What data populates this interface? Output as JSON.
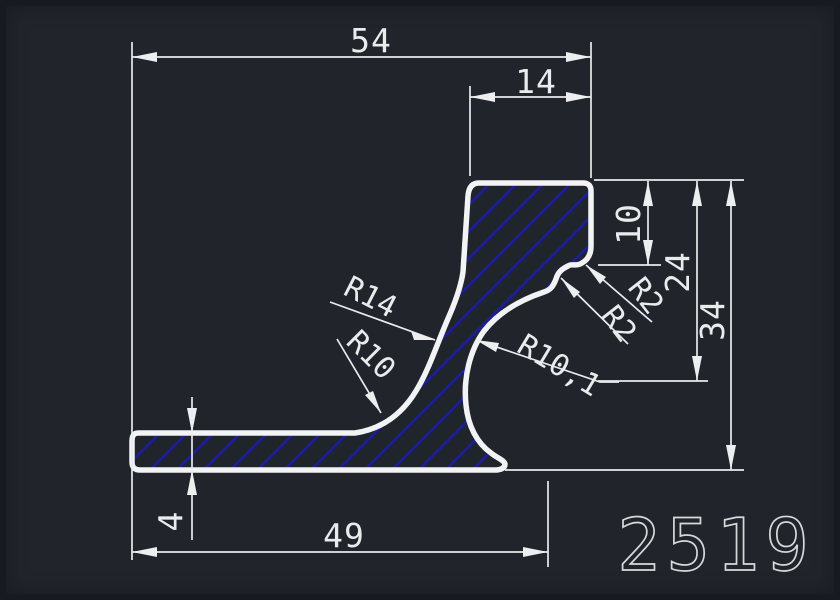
{
  "canvas": {
    "background": "#21252b",
    "frame_color": "#171b21",
    "line_color": "#e8eaec",
    "outline_color": "#f2f3f5",
    "hatch_color": "#1b1bb2",
    "text_color": "#e9ebed",
    "part_number_color": "#d6d8da"
  },
  "drawing": {
    "part_number": "2519",
    "dimensions": {
      "overall_width": "54",
      "top_width": "14",
      "step_height": "10",
      "mid_height": "24",
      "overall_height": "34",
      "base_thickness": "4",
      "base_width": "49"
    },
    "radii": {
      "outer_left": "R14",
      "inner_left": "R10",
      "inner_right": "R10,1",
      "step_upper": "R2",
      "step_lower": "R2"
    }
  }
}
